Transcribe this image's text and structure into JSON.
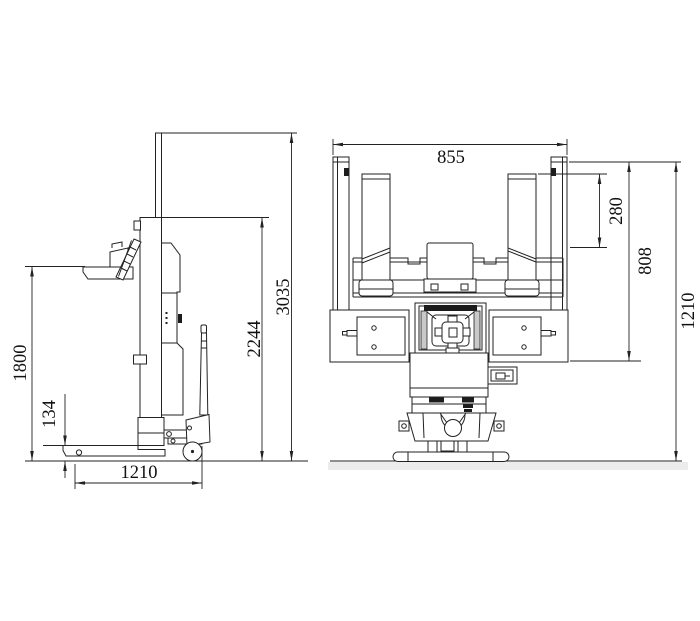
{
  "side_view": {
    "dimensions": {
      "overall_height": "3035",
      "mast_height": "2244",
      "platform_height": "1800",
      "fork_height": "134",
      "base_length": "1210"
    }
  },
  "front_view": {
    "dimensions": {
      "overall_width": "855",
      "fork_drop": "280",
      "body_height": "808",
      "overall_height": "1210"
    }
  }
}
